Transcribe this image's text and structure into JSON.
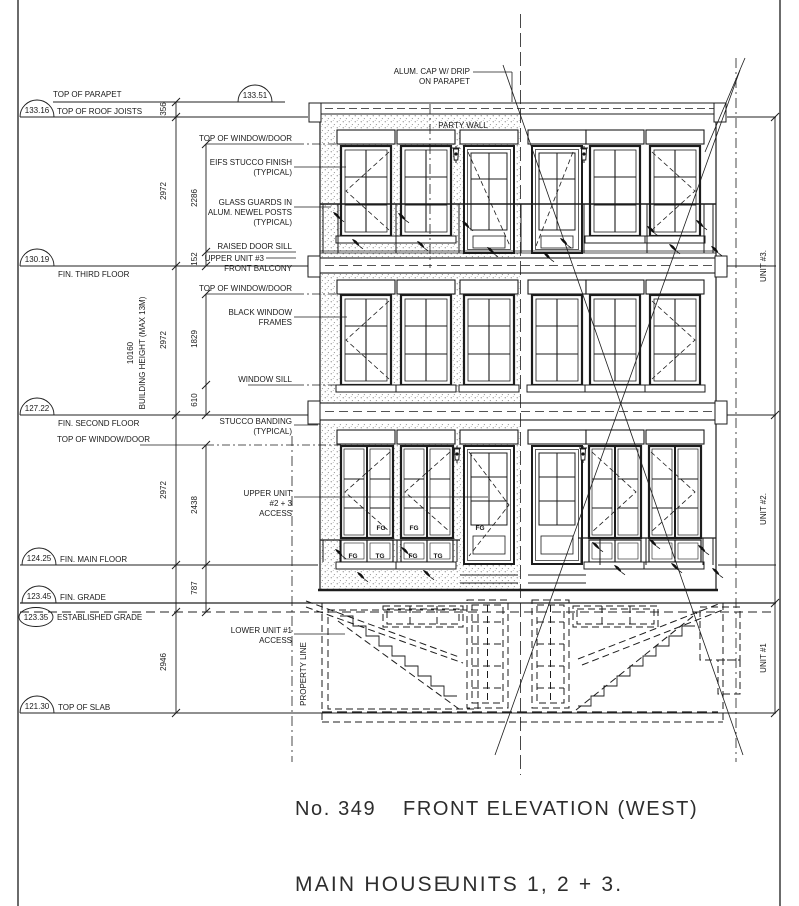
{
  "title_block": {
    "number": "No. 349",
    "title": "FRONT ELEVATION (WEST)",
    "subtitle1": "MAIN HOUSE",
    "subtitle2": "UNITS 1, 2 + 3."
  },
  "levels": {
    "parapet": {
      "label": "TOP OF PARAPET",
      "value": "133.51"
    },
    "roof": {
      "label": "TOP OF ROOF JOISTS",
      "value": "133.16"
    },
    "third": {
      "label": "FIN. THIRD FLOOR",
      "value": "130.19"
    },
    "second": {
      "label": "FIN. SECOND FLOOR",
      "value": "127.22"
    },
    "main": {
      "label": "FIN. MAIN FLOOR",
      "value": "124.25"
    },
    "grade": {
      "label": "FIN. GRADE",
      "value": "123.45"
    },
    "egrade": {
      "label": "ESTABLISHED GRADE",
      "value": "123.35"
    },
    "slab": {
      "label": "TOP OF SLAB",
      "value": "121.30"
    }
  },
  "dims": {
    "parapet": "356",
    "floor": "2972",
    "basement": "2946",
    "win3": "2286",
    "sill3": "152",
    "win2": "1829",
    "sill2": "610",
    "win1": "2438",
    "grade": "787",
    "height": "10160",
    "height_note": "BUILDING HEIGHT (MAX 13M)"
  },
  "notes": {
    "alum_cap1": "ALUM. CAP W/ DRIP",
    "alum_cap2": "ON PARAPET",
    "party_wall": "PARTY WALL",
    "top_window": "TOP OF WINDOW/DOOR",
    "eifs1": "EIFS STUCCO FINISH",
    "typical": "(TYPICAL)",
    "guards1": "GLASS GUARDS IN",
    "guards2": "ALUM. NEWEL POSTS",
    "raised_sill": "RAISED DOOR SILL",
    "upper3": "UPPER UNIT #3",
    "balcony": "FRONT BALCONY",
    "black1": "BLACK WINDOW",
    "black2": "FRAMES",
    "wsill": "WINDOW SILL",
    "banding": "STUCCO BANDING",
    "access231": "UPPER UNIT",
    "access232": "#2 + 3",
    "access233": "ACCESS",
    "access11": "LOWER UNIT #1",
    "access12": "ACCESS",
    "property": "PROPERTY LINE"
  },
  "units": {
    "u3": "UNIT #3.",
    "u2": "UNIT #2.",
    "u1": "UNIT #1"
  },
  "glazing": {
    "fg": "FG",
    "tg": "TG"
  },
  "colors": {
    "line": "#1c1c1c",
    "text": "#1a1a1a"
  }
}
